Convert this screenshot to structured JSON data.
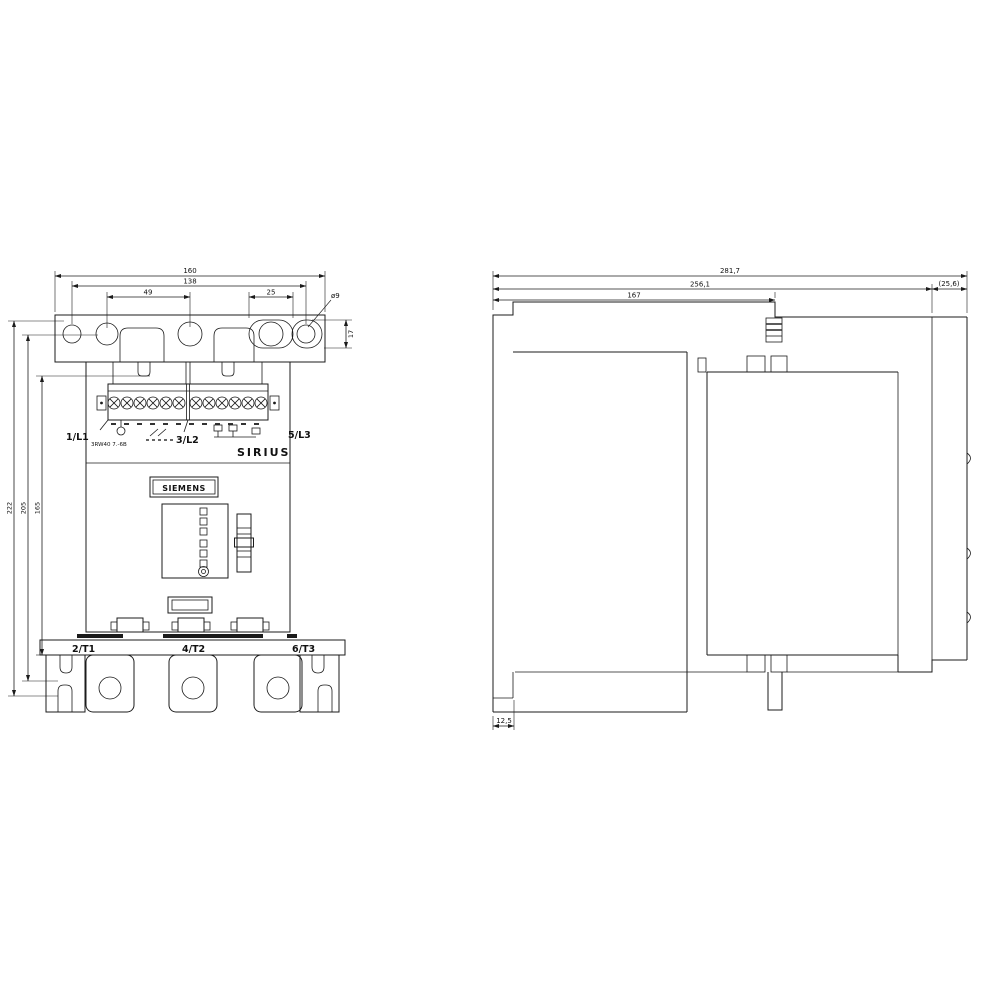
{
  "front_view": {
    "dim_width_total": "160",
    "dim_mount_span": "138",
    "dim_hole_offset_left": "49",
    "dim_slot_right": "25",
    "dim_hole_diameter": "ø9",
    "dim_slot_height": "17",
    "dim_height_outer": "222",
    "dim_height_mid": "205",
    "dim_height_inner": "165",
    "terminal_top_left": "1/L1",
    "terminal_top_left_note": "3RW40 7.-6B",
    "terminal_top_mid": "3/L2",
    "terminal_top_right": "5/L3",
    "product_line": "SIRIUS",
    "brand_logo": "SIEMENS",
    "terminal_bottom_left": "2/T1",
    "terminal_bottom_mid": "4/T2",
    "terminal_bottom_right": "6/T3"
  },
  "side_view": {
    "dim_depth_total": "281,7",
    "dim_depth_body": "256,1",
    "dim_depth_front": "167",
    "dim_depth_tail": "(25,6)",
    "dim_foot": "12,5"
  }
}
